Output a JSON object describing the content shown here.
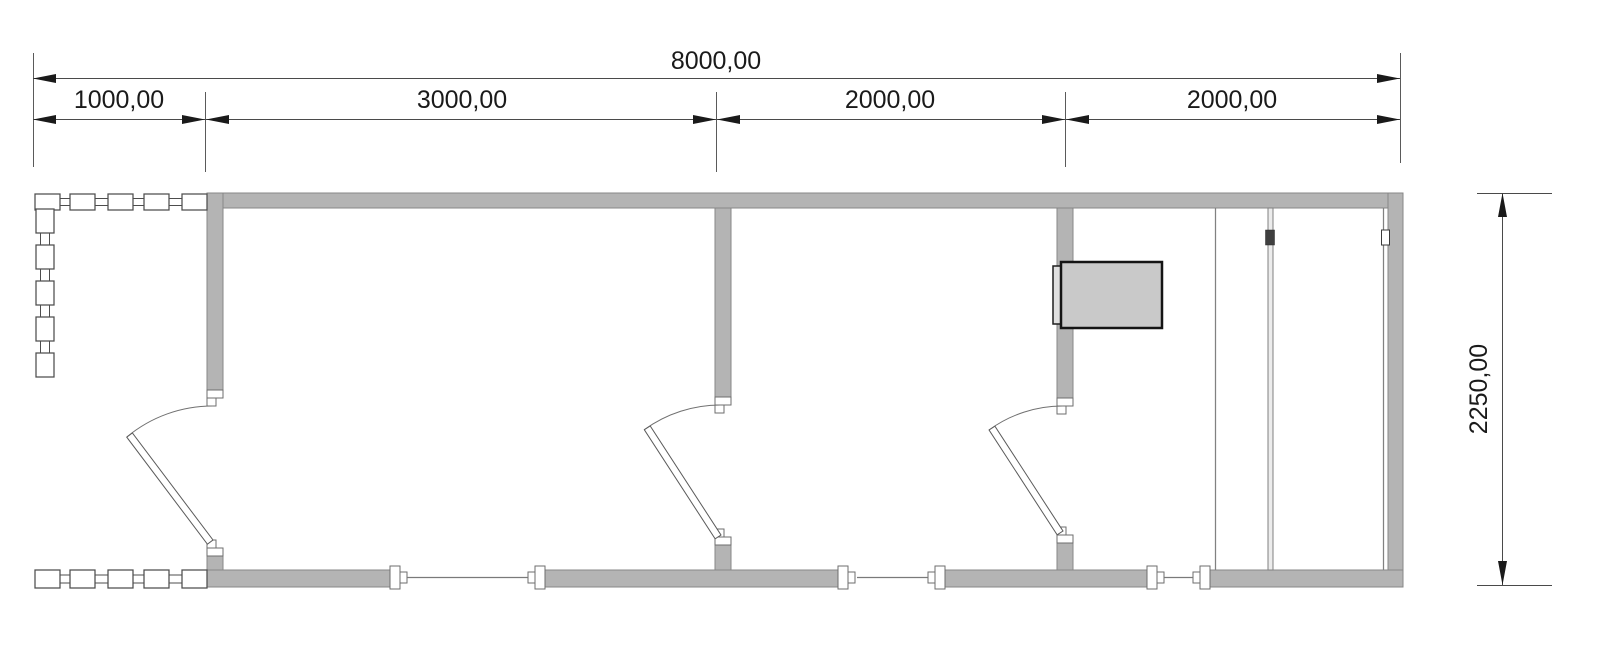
{
  "drawing": {
    "type": "architectural floor plan",
    "dimensions": {
      "total_width_label": "8000,00",
      "segments": [
        {
          "label": "1000,00"
        },
        {
          "label": "3000,00"
        },
        {
          "label": "2000,00"
        },
        {
          "label": "2000,00"
        }
      ],
      "height_label": "2250,00"
    },
    "features": {
      "rooms": [
        "porch with railing",
        "room 3000",
        "room 2000",
        "room 2000 with heater and sliding panels"
      ],
      "doors": 3,
      "windows": 3
    },
    "colors": {
      "background": "#ffffff",
      "wall_fill": "#b4b4b4",
      "wall_stroke": "#878787",
      "dimension_line": "#4a4a4a",
      "text": "#1a1a1a",
      "heater_fill": "#c9c9c9",
      "heater_plate_fill": "#e0e0e0"
    }
  }
}
